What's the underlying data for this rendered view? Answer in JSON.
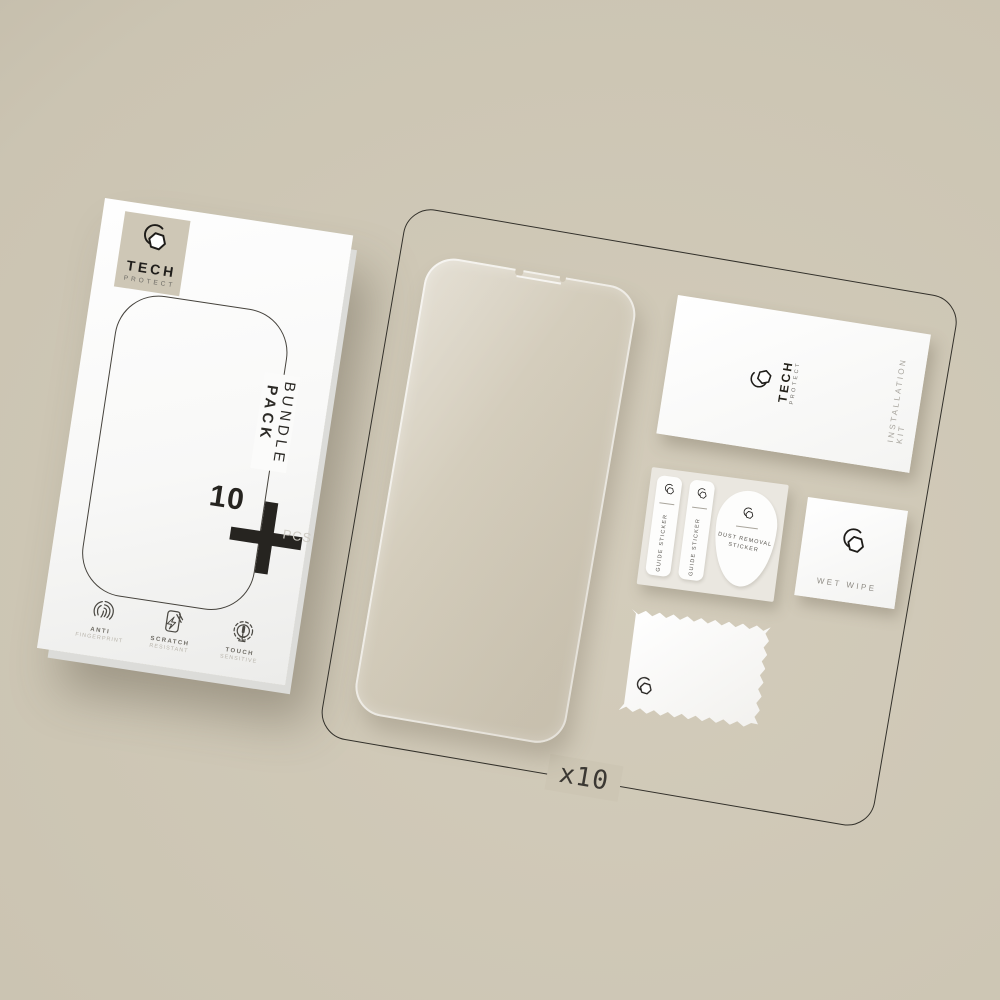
{
  "brand": {
    "word1": "TECH",
    "word2": "PROTECT"
  },
  "box": {
    "bundle_word1": "BUNDLE",
    "bundle_word2": "PACK",
    "qty_number": "10",
    "qty_unit": "PCS",
    "features": [
      {
        "line1": "ANTI",
        "line2": "FINGERPRINT",
        "icon": "fingerprint-icon"
      },
      {
        "line1": "SCRATCH",
        "line2": "RESISTANT",
        "icon": "scratch-resistant-icon"
      },
      {
        "line1": "TOUCH",
        "line2": "SENSITIVE",
        "icon": "touch-sensitive-icon"
      }
    ]
  },
  "kit": {
    "label": "INSTALLATION KIT"
  },
  "stickers": {
    "guide1": "GUIDE STICKER",
    "guide2": "GUIDE STICKER",
    "dust_line1": "DUST REMOVAL",
    "dust_line2": "STICKER"
  },
  "wipe": {
    "label": "WET WIPE"
  },
  "board": {
    "count_label": "x10"
  },
  "icons": {
    "brand_logo": "hexagon-nut-with-arc",
    "plus": "plus-cross-icon"
  },
  "colors": {
    "background": "#cbc4b2",
    "board_outline": "#32302a",
    "ink": "#262420",
    "beige_square": "#cec7b6",
    "protector_fill": "#d3ccbb",
    "card_white": "#fdfdfc",
    "muted_text": "#8f8c85"
  }
}
